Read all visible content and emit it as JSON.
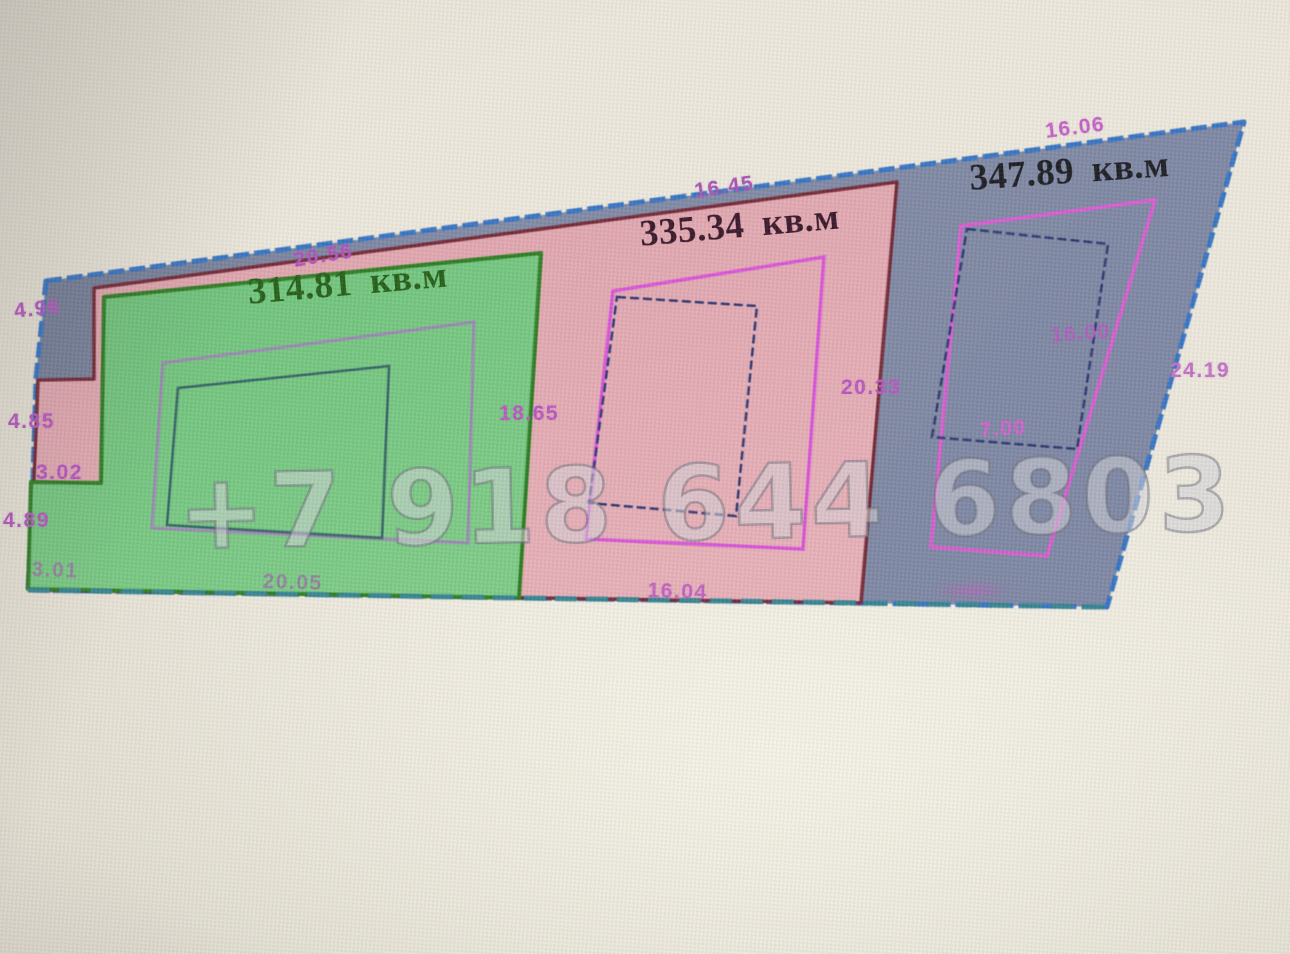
{
  "watermark": {
    "text": "+7 918 644 6803"
  },
  "plots": {
    "green": {
      "area_label": "314.81 кв.м",
      "fill": "#6fc57c",
      "outline": "#26791b"
    },
    "pink": {
      "area_label": "335.34 кв.м",
      "fill": "#e3a7b0",
      "outline": "#6f2130"
    },
    "gray": {
      "area_label": "347.89 кв.м",
      "fill": "#7b85a1",
      "outline": "#3070c2"
    }
  },
  "dimensions": {
    "outer_left_top": "4.96",
    "left_upper": "4.85",
    "notch_width": "3.02",
    "left_lower": "4.89",
    "left_bottom": "3.01",
    "green_top": "20.56",
    "green_right": "18.65",
    "green_bottom": "20.05",
    "pink_top": "16.45",
    "pink_right": "20.33",
    "pink_bottom": "16.04",
    "gray_top": "16.06",
    "gray_right": "24.19",
    "gray_inner_height": "16.00",
    "gray_inner_width": "7.00"
  },
  "colors": {
    "background": "#e8e4d8",
    "parcel_gray_fill": "#7b85a1",
    "blue_outline": "#3070c2",
    "teal_bottom_edge": "#2f808e",
    "dimension_text": "#b552c0",
    "magenta_inner_quad": "#d84fd8",
    "navy_inner_quad": "#262f6d",
    "purple_inner_quad": "#9a82b4",
    "teal_inner_quad": "#2c5c60",
    "watermark_text": "#f0f0f4"
  }
}
